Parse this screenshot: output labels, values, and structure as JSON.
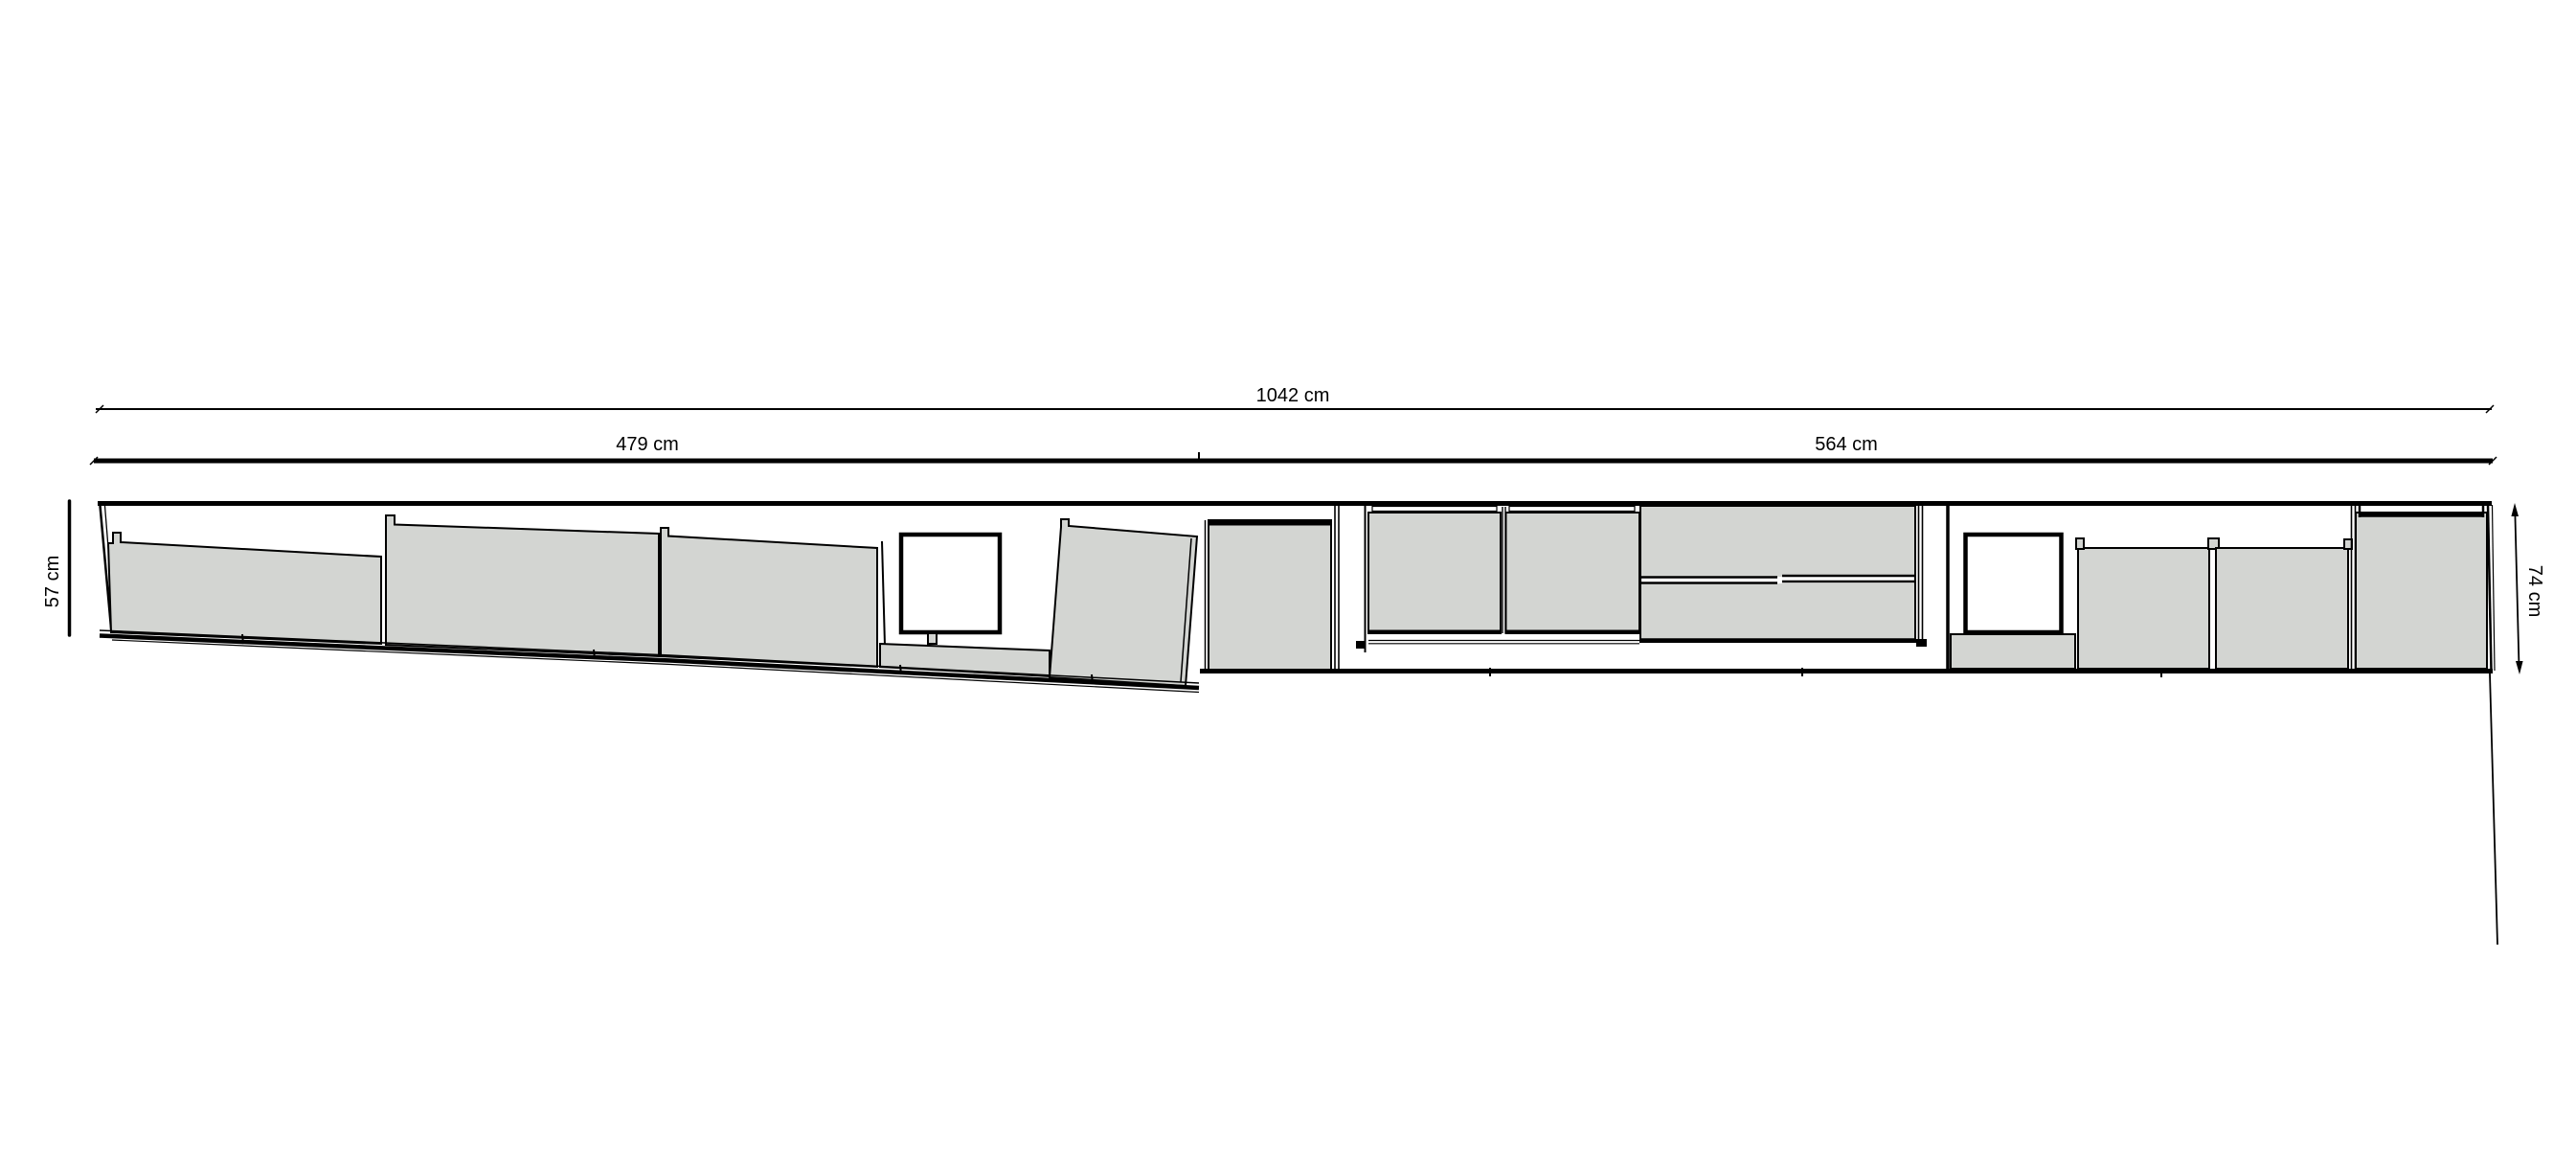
{
  "drawing": {
    "dimensions": {
      "total_width": {
        "label": "1042 cm",
        "value": 1042,
        "unit": "cm"
      },
      "left_section_width": {
        "label": "479 cm",
        "value": 479,
        "unit": "cm"
      },
      "right_section_width": {
        "label": "564 cm",
        "value": 564,
        "unit": "cm"
      },
      "left_height": {
        "label": "57 cm",
        "value": 57,
        "unit": "cm"
      },
      "right_height": {
        "label": "74 cm",
        "value": 74,
        "unit": "cm"
      }
    },
    "colors": {
      "line": "#000000",
      "panel_fill": "#d3d5d2",
      "background": "#ffffff"
    }
  }
}
